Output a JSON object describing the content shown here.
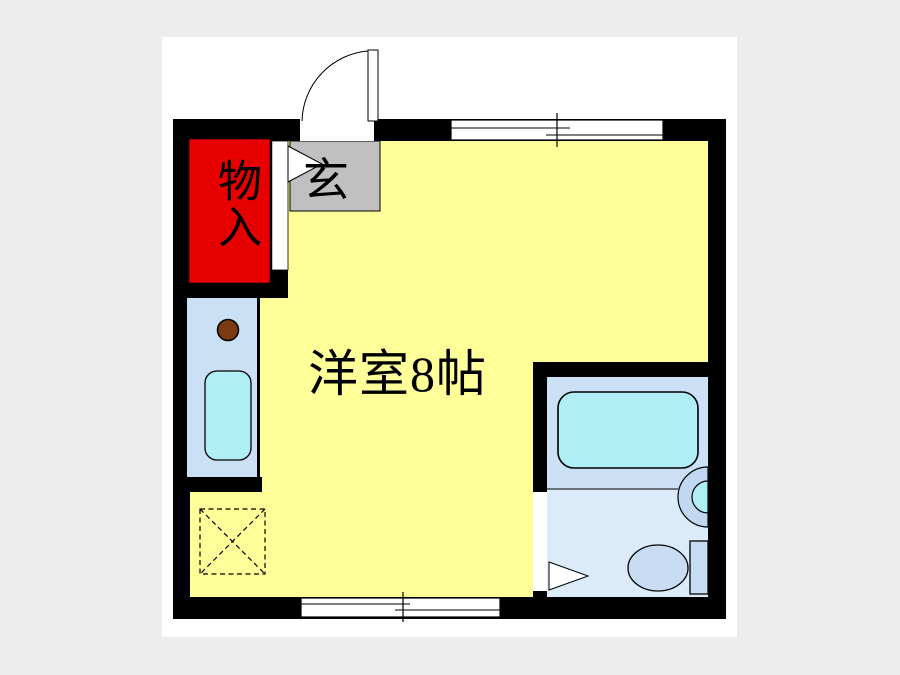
{
  "floorplan": {
    "type": "japanese-apartment-floor-plan",
    "rooms": {
      "main_room": {
        "label": "洋室8帖",
        "size_tatami": 8
      },
      "entrance": {
        "label": "玄"
      },
      "storage": {
        "label": "物入"
      }
    },
    "fixtures": [
      "entrance-door",
      "storage-door-indicator",
      "gas-burner",
      "kitchen-sink",
      "refrigerator-space",
      "bathtub",
      "wash-basin",
      "toilet",
      "sliding-window-top",
      "sliding-window-bottom",
      "bathroom-door-indicator"
    ],
    "colors": {
      "background": "#EDEDED",
      "page": "#FFFFFF",
      "wall": "#000000",
      "room_floor": "#FFFF99",
      "storage": "#E60000",
      "entrance_floor": "#C0C0C0",
      "kitchen_floor": "#C9E0F5",
      "bathroom_floor": "#CDE1F6",
      "toilet_floor": "#DCEBFA",
      "fixture_water": "#B0EEF5",
      "toilet_fixture": "#C8DDF4",
      "basin_ring": "#C0D8F2",
      "burner": "#7B3A12"
    }
  }
}
